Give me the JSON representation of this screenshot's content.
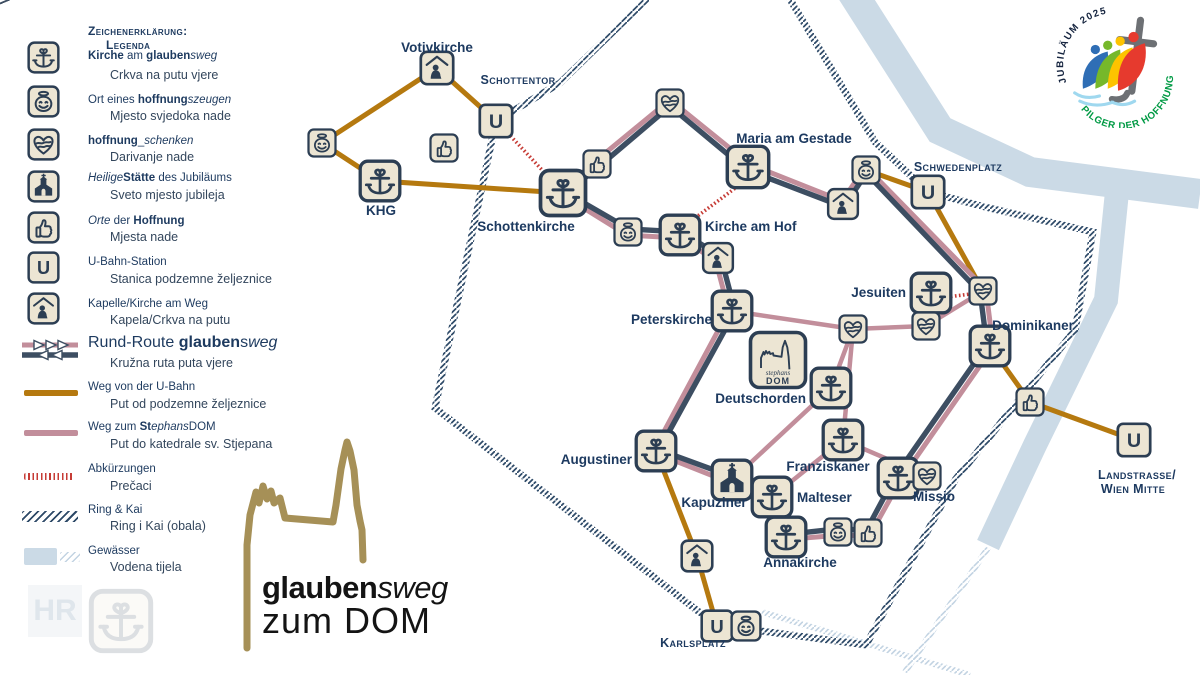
{
  "colors": {
    "navy": "#2c3e53",
    "route_navy": "#3d4e62",
    "pink": "#c28e9b",
    "brown": "#b5790f",
    "red": "#c63c36",
    "water": "#cbdae6",
    "ring": "#2e4a68",
    "ring_light": "#c2d3e2",
    "gold": "#a69057",
    "label": "#1d3a60",
    "green": "#009a44",
    "icon_bg": "#ece5d3"
  },
  "legend": {
    "title1": "Zeichenerklärung:",
    "title2": "Legenda",
    "items": [
      {
        "sample": "kirche",
        "y": 57,
        "dy": 58,
        "hy": 77,
        "de": [
          [
            "b",
            "Kirche"
          ],
          [
            "r",
            " am "
          ],
          [
            "b",
            "glauben"
          ],
          [
            "i",
            "sweg"
          ]
        ],
        "hr": "Crkva na putu vjere"
      },
      {
        "sample": "smiley",
        "y": 101,
        "dy": 102,
        "hy": 118,
        "de": [
          [
            "r",
            "Ort eines "
          ],
          [
            "b",
            "hoffnung"
          ],
          [
            "i",
            "szeugen"
          ]
        ],
        "hr": "Mjesto svjedoka nade"
      },
      {
        "sample": "heart",
        "y": 144,
        "dy": 143,
        "hy": 159,
        "de": [
          [
            "b",
            "hoffnung"
          ],
          [
            "r",
            "_"
          ],
          [
            "i",
            "schenken"
          ]
        ],
        "hr": "Darivanje nade"
      },
      {
        "sample": "church",
        "y": 186,
        "dy": 180,
        "hy": 197,
        "de": [
          [
            "i",
            "Heilige"
          ],
          [
            "b",
            "Stätte"
          ],
          [
            "r",
            " des Jubiläums"
          ]
        ],
        "hr": "Sveto mjesto jubileja"
      },
      {
        "sample": "thumbs",
        "y": 227,
        "dy": 223,
        "hy": 239,
        "de": [
          [
            "i",
            "Orte"
          ],
          [
            "r",
            " der "
          ],
          [
            "b",
            "Hoffnung"
          ]
        ],
        "hr": "Mjesta nade"
      },
      {
        "sample": "ubahn",
        "y": 267,
        "dy": 264,
        "hy": 281,
        "de": [
          [
            "r",
            "U-Bahn-Station"
          ]
        ],
        "hr": "Stanica podzemne željeznice"
      },
      {
        "sample": "chapel",
        "y": 308,
        "dy": 306,
        "hy": 322,
        "de": [
          [
            "r",
            "Kapelle/Kirche am Weg"
          ]
        ],
        "hr": "Kapela/Crkva na putu"
      },
      {
        "sample": "rr",
        "y": 350,
        "big": true,
        "dy": 342,
        "hy": 365,
        "de": [
          [
            "r",
            "Rund-Route "
          ],
          [
            "b",
            "glauben"
          ],
          [
            "r",
            "s"
          ],
          [
            "i",
            "weg"
          ]
        ],
        "hr": "Kružna ruta puta vjere"
      },
      {
        "sample": "brown",
        "y": 393,
        "dy": 389,
        "hy": 406,
        "de": [
          [
            "r",
            "Weg von der U-Bahn"
          ]
        ],
        "hr": "Put od podzemne željeznice"
      },
      {
        "sample": "pink",
        "y": 433,
        "dy": 429,
        "hy": 446,
        "de": [
          [
            "r",
            "Weg zum "
          ],
          [
            "b",
            "St"
          ],
          [
            "i",
            "ephans"
          ],
          [
            "r",
            "DOM"
          ]
        ],
        "hr": "Put do katedrale sv. Stjepana"
      },
      {
        "sample": "dotted",
        "y": 476,
        "dy": 471,
        "hy": 488,
        "de": [
          [
            "r",
            "Abkürzungen"
          ]
        ],
        "hr": "Prečaci"
      },
      {
        "sample": "hatch",
        "y": 516,
        "dy": 512,
        "hy": 528,
        "de": [
          [
            "r",
            "Ring & Kai"
          ]
        ],
        "hr": "Ring i Kai (obala)"
      },
      {
        "sample": "water",
        "y": 556,
        "dy": 553,
        "hy": 569,
        "de": [
          [
            "r",
            "Gewässer"
          ]
        ],
        "hr": "Vodena tijela"
      }
    ]
  },
  "logo": {
    "bold_part": "glauben",
    "italic_part": "sweg",
    "line2": "zum DOM"
  },
  "watermark": {
    "hr": "HR"
  },
  "jubilee": {
    "top_text": "JUBILÄUM 2025",
    "bottom_text": "PILGER DER HOFFNUNG"
  },
  "map": {
    "u_letter": "U",
    "dom_icon": {
      "line1": "stephans",
      "line2": "DOM"
    },
    "nodes": [
      {
        "id": "smiley-votiv-west",
        "type": "smiley",
        "x": 322,
        "y": 143,
        "s": 30
      },
      {
        "id": "votivkirche",
        "type": "chapel",
        "x": 437,
        "y": 68,
        "s": 36,
        "label": "Votivkirche",
        "lx": 437,
        "ly": 52,
        "la": "middle",
        "lc": "place"
      },
      {
        "id": "thumbs-schottentor",
        "type": "thumbs",
        "x": 444,
        "y": 148,
        "s": 30
      },
      {
        "id": "u-schottentor",
        "type": "ubahn",
        "x": 496,
        "y": 121,
        "s": 36,
        "label": "Schottentor",
        "lx": 518,
        "ly": 84,
        "la": "middle",
        "lc": "station"
      },
      {
        "id": "khg",
        "type": "kirche",
        "x": 380,
        "y": 181,
        "s": 44,
        "label": "KHG",
        "lx": 381,
        "ly": 215,
        "la": "middle",
        "lc": "place"
      },
      {
        "id": "schottenkirche",
        "type": "kirche",
        "x": 563,
        "y": 193,
        "s": 50,
        "label": "Schottenkirche",
        "lx": 526,
        "ly": 231,
        "la": "middle",
        "lc": "place"
      },
      {
        "id": "heart-freyung",
        "type": "heart",
        "x": 670,
        "y": 103,
        "s": 30
      },
      {
        "id": "thumbs-moelkerbastei",
        "type": "thumbs",
        "x": 597,
        "y": 164,
        "s": 30
      },
      {
        "id": "maria-am-gestade",
        "type": "kirche",
        "x": 748,
        "y": 167,
        "s": 46,
        "label": "Maria am Gestade",
        "lx": 794,
        "ly": 143,
        "la": "middle",
        "lc": "place"
      },
      {
        "id": "chapel-am-gestade",
        "type": "chapel",
        "x": 843,
        "y": 204,
        "s": 33
      },
      {
        "id": "smiley-morzinplatz",
        "type": "smiley",
        "x": 866,
        "y": 170,
        "s": 30
      },
      {
        "id": "u-schwedenplatz",
        "type": "ubahn",
        "x": 928,
        "y": 192,
        "s": 36,
        "label": "Schwedenplatz",
        "lx": 958,
        "ly": 171,
        "la": "middle",
        "lc": "station"
      },
      {
        "id": "smiley-am-hof",
        "type": "smiley",
        "x": 628,
        "y": 232,
        "s": 30
      },
      {
        "id": "kirche-am-hof",
        "type": "kirche",
        "x": 680,
        "y": 235,
        "s": 44,
        "label": "Kirche am Hof",
        "lx": 705,
        "ly": 231,
        "la": "start",
        "lc": "place"
      },
      {
        "id": "chapel-am-hof",
        "type": "chapel",
        "x": 718,
        "y": 258,
        "s": 33
      },
      {
        "id": "peterskirche",
        "type": "kirche",
        "x": 732,
        "y": 311,
        "s": 44,
        "label": "Peterskirche",
        "lx": 712,
        "ly": 324,
        "la": "end",
        "lc": "place"
      },
      {
        "id": "stephansdom",
        "type": "dom",
        "x": 778,
        "y": 360,
        "s": 60
      },
      {
        "id": "heart-stephansplatz",
        "type": "heart",
        "x": 853,
        "y": 329,
        "s": 30
      },
      {
        "id": "jesuiten",
        "type": "kirche",
        "x": 931,
        "y": 293,
        "s": 44,
        "label": "Jesuiten",
        "lx": 906,
        "ly": 297,
        "la": "end",
        "lc": "place"
      },
      {
        "id": "heart-postgasse",
        "type": "heart",
        "x": 983,
        "y": 291,
        "s": 30
      },
      {
        "id": "heart-schoenlaterngasse",
        "type": "heart",
        "x": 926,
        "y": 326,
        "s": 30
      },
      {
        "id": "dominikaner",
        "type": "kirche",
        "x": 990,
        "y": 346,
        "s": 44,
        "label": "Dominikaner",
        "lx": 1033,
        "ly": 330,
        "la": "middle",
        "lc": "place"
      },
      {
        "id": "thumbs-stadtpark",
        "type": "thumbs",
        "x": 1030,
        "y": 402,
        "s": 30
      },
      {
        "id": "u-landstrasse",
        "type": "ubahn",
        "x": 1134,
        "y": 440,
        "s": 36,
        "label": "Landstrasse/",
        "lx": 1137,
        "ly": 479,
        "la": "middle",
        "lc": "station",
        "label2": "Wien Mitte",
        "l2x": 1133,
        "l2y": 493
      },
      {
        "id": "deutschorden",
        "type": "kirche",
        "x": 831,
        "y": 388,
        "s": 44,
        "label": "Deutschorden",
        "lx": 806,
        "ly": 403,
        "la": "end",
        "lc": "place"
      },
      {
        "id": "franziskaner",
        "type": "kirche",
        "x": 843,
        "y": 440,
        "s": 44,
        "label": "Franziskaner",
        "lx": 828,
        "ly": 471,
        "la": "middle",
        "lc": "place"
      },
      {
        "id": "augustiner",
        "type": "kirche",
        "x": 656,
        "y": 451,
        "s": 44,
        "label": "Augustiner",
        "lx": 632,
        "ly": 464,
        "la": "end",
        "lc": "place"
      },
      {
        "id": "kapuziner",
        "type": "church",
        "x": 732,
        "y": 480,
        "s": 44,
        "label": "Kapuziner",
        "lx": 714,
        "ly": 507,
        "la": "middle",
        "lc": "place"
      },
      {
        "id": "malteser",
        "type": "kirche",
        "x": 772,
        "y": 497,
        "s": 44,
        "label": "Malteser",
        "lx": 797,
        "ly": 502,
        "la": "start",
        "lc": "place"
      },
      {
        "id": "annakirche",
        "type": "kirche",
        "x": 786,
        "y": 537,
        "s": 44,
        "label": "Annakirche",
        "lx": 800,
        "ly": 567,
        "la": "middle",
        "lc": "place"
      },
      {
        "id": "smiley-annagasse",
        "type": "smiley",
        "x": 838,
        "y": 532,
        "s": 30
      },
      {
        "id": "thumbs-annagasse",
        "type": "thumbs",
        "x": 868,
        "y": 533,
        "s": 30
      },
      {
        "id": "missio",
        "type": "kirche",
        "x": 898,
        "y": 478,
        "s": 44,
        "label": "Missio",
        "lx": 934,
        "ly": 501,
        "la": "middle",
        "lc": "place"
      },
      {
        "id": "heart-missio",
        "type": "heart",
        "x": 927,
        "y": 476,
        "s": 30
      },
      {
        "id": "chapel-karlsplatz-weg",
        "type": "chapel",
        "x": 697,
        "y": 556,
        "s": 34
      },
      {
        "id": "u-karlsplatz",
        "type": "ubahn",
        "x": 717,
        "y": 626,
        "s": 34,
        "label": "Karlsplatz",
        "lx": 693,
        "ly": 647,
        "la": "middle",
        "lc": "station"
      },
      {
        "id": "smiley-karlsplatz",
        "type": "smiley",
        "x": 746,
        "y": 626,
        "s": 32
      }
    ],
    "edges": [
      {
        "type": "water",
        "w": 30,
        "pts": [
          [
            852,
            -8
          ],
          [
            940,
            130
          ],
          [
            1030,
            172
          ],
          [
            1200,
            194
          ]
        ]
      },
      {
        "type": "water",
        "w": 24,
        "pts": [
          [
            1117,
            192
          ],
          [
            1106,
            300
          ],
          [
            1035,
            445
          ],
          [
            988,
            545
          ]
        ]
      },
      {
        "type": "ringlight",
        "pts": [
          [
            988,
            548
          ],
          [
            905,
            672
          ]
        ]
      },
      {
        "type": "ringlight",
        "pts": [
          [
            762,
            612
          ],
          [
            970,
            675
          ]
        ]
      },
      {
        "type": "ring",
        "pts": [
          [
            650,
            -4
          ],
          [
            560,
            83
          ],
          [
            496,
            121
          ],
          [
            435,
            408
          ],
          [
            716,
            625
          ],
          [
            866,
            645
          ],
          [
            955,
            480
          ],
          [
            1075,
            330
          ],
          [
            1093,
            232
          ],
          [
            985,
            207
          ],
          [
            928,
            192
          ],
          [
            875,
            142
          ],
          [
            788,
            -4
          ]
        ]
      },
      {
        "type": "ubahn",
        "pts": [
          [
            322,
            143
          ],
          [
            437,
            68
          ],
          [
            496,
            121
          ]
        ]
      },
      {
        "type": "ubahn",
        "pts": [
          [
            322,
            143
          ],
          [
            380,
            181
          ],
          [
            563,
            193
          ]
        ]
      },
      {
        "type": "ubahn",
        "pts": [
          [
            866,
            170
          ],
          [
            928,
            192
          ]
        ]
      },
      {
        "type": "ubahn",
        "pts": [
          [
            928,
            192
          ],
          [
            983,
            291
          ]
        ]
      },
      {
        "type": "ubahn",
        "pts": [
          [
            990,
            346
          ],
          [
            1030,
            402
          ],
          [
            1134,
            440
          ]
        ]
      },
      {
        "type": "ubahn",
        "pts": [
          [
            656,
            451
          ],
          [
            697,
            556
          ],
          [
            717,
            626
          ]
        ]
      },
      {
        "type": "short",
        "pts": [
          [
            505,
            130
          ],
          [
            556,
            185
          ]
        ]
      },
      {
        "type": "short",
        "pts": [
          [
            738,
            186
          ],
          [
            695,
            218
          ]
        ]
      },
      {
        "type": "short",
        "pts": [
          [
            947,
            297
          ],
          [
            971,
            294
          ]
        ]
      },
      {
        "type": "dom",
        "pts": [
          [
            732,
            311
          ],
          [
            853,
            329
          ]
        ]
      },
      {
        "type": "dom",
        "pts": [
          [
            853,
            329
          ],
          [
            926,
            326
          ],
          [
            983,
            291
          ]
        ]
      },
      {
        "type": "dom",
        "pts": [
          [
            853,
            329
          ],
          [
            831,
            388
          ],
          [
            732,
            480
          ]
        ]
      },
      {
        "type": "dom",
        "pts": [
          [
            853,
            329
          ],
          [
            843,
            440
          ]
        ]
      },
      {
        "type": "dom",
        "pts": [
          [
            843,
            440
          ],
          [
            927,
            476
          ]
        ]
      },
      {
        "type": "dom",
        "pts": [
          [
            772,
            497
          ],
          [
            843,
            440
          ]
        ]
      },
      {
        "type": "rund",
        "closed": true,
        "pts": [
          [
            563,
            193
          ],
          [
            597,
            164
          ],
          [
            670,
            103
          ],
          [
            748,
            167
          ],
          [
            843,
            204
          ],
          [
            866,
            170
          ],
          [
            983,
            291
          ],
          [
            990,
            346
          ],
          [
            898,
            478
          ],
          [
            868,
            533
          ],
          [
            838,
            532
          ],
          [
            786,
            537
          ],
          [
            772,
            497
          ],
          [
            732,
            480
          ],
          [
            656,
            451
          ],
          [
            732,
            311
          ],
          [
            718,
            258
          ],
          [
            680,
            235
          ],
          [
            628,
            232
          ]
        ]
      }
    ],
    "arrows": [
      {
        "x": 633,
        "y": 133,
        "a": -40
      },
      {
        "x": 710,
        "y": 133,
        "a": 40
      },
      {
        "x": 920,
        "y": 228,
        "a": 46
      },
      {
        "x": 947,
        "y": 410,
        "a": 125
      },
      {
        "x": 694,
        "y": 466,
        "a": 21
      },
      {
        "x": 697,
        "y": 378,
        "a": 118
      },
      {
        "x": 600,
        "y": 221,
        "a": 211
      }
    ],
    "spire": "M247,648 L247,545 L250,515 L256,492 L259,503 L263,486 L267,499 L271,491 L274,503 L280,498 L285,518 L333,522 L336,505 L341,469 L345,450 L347,442 L350,451 L354,470 L357,505 L360,521 L362,530 L363,560"
  }
}
